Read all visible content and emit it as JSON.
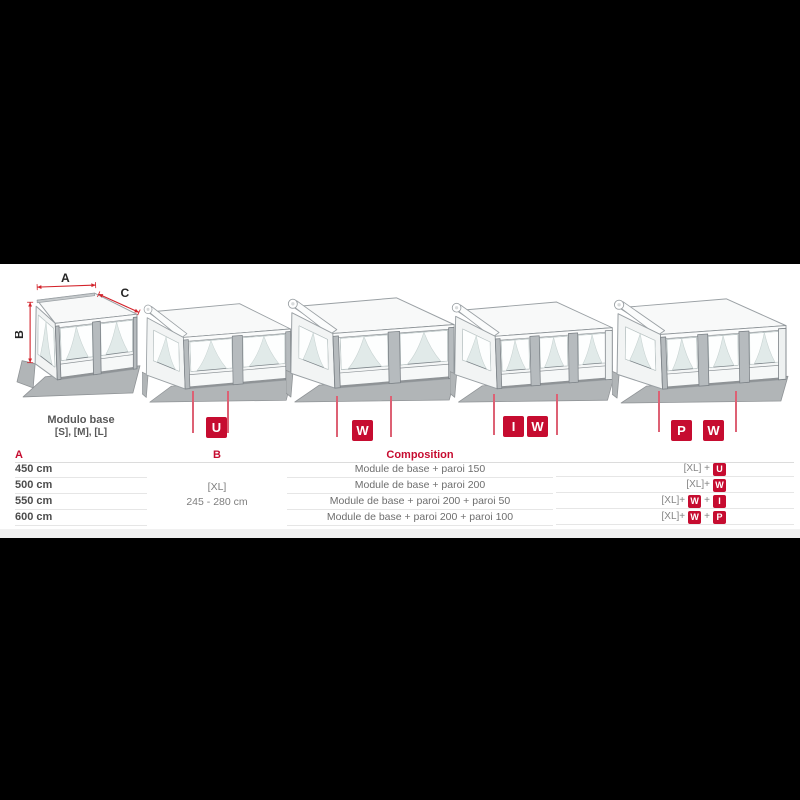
{
  "colors": {
    "accent": "#c60c30",
    "marker_line": "#dd6174",
    "table_line": "#e6e6e6"
  },
  "diagram": {
    "base_module": {
      "label_line1": "Modulo base",
      "label_line2": "[S], [M], [L]"
    },
    "dimension_labels": {
      "a": "A",
      "b": "B",
      "c": "C"
    },
    "badge_groups": [
      [
        "U"
      ],
      [
        "W"
      ],
      [
        "I",
        "W"
      ],
      [
        "P",
        "W"
      ]
    ]
  },
  "table": {
    "headers": {
      "a": "A",
      "b": "B",
      "composition": "Composition"
    },
    "col_b_merged": {
      "line1": "[XL]",
      "line2": "245 - 280 cm"
    },
    "code_plus": "+",
    "rows": [
      {
        "a": "450 cm",
        "composition": "Module de base + paroi 150",
        "code_prefix": "[XL] +",
        "code_badges": [
          "U"
        ]
      },
      {
        "a": "500 cm",
        "composition": "Module de base + paroi 200",
        "code_prefix": "[XL]+",
        "code_badges": [
          "W"
        ]
      },
      {
        "a": "550 cm",
        "composition": "Module de base + paroi 200 + paroi 50",
        "code_prefix": "[XL]+",
        "code_badges": [
          "W",
          "I"
        ]
      },
      {
        "a": "600 cm",
        "composition": "Module de base + paroi 200 + paroi 100",
        "code_prefix": "[XL]+",
        "code_badges": [
          "W",
          "P"
        ]
      }
    ]
  }
}
